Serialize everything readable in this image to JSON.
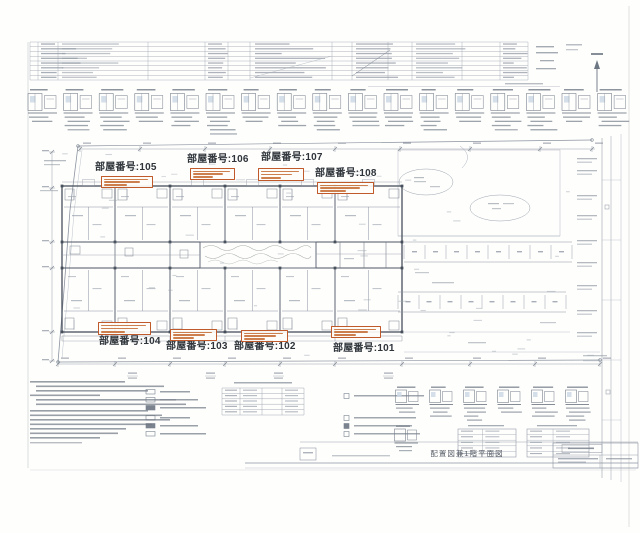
{
  "sheet": {
    "title": "配置図兼1階平面図"
  },
  "rooms": [
    {
      "id": "105",
      "label": "部屋番号:105",
      "label_x": 95,
      "label_y": 163,
      "box_x": 101,
      "box_y": 176,
      "box_w": 52,
      "box_h": 12
    },
    {
      "id": "106",
      "label": "部屋番号:106",
      "label_x": 187,
      "label_y": 155,
      "box_x": 190,
      "box_y": 168,
      "box_w": 45,
      "box_h": 12
    },
    {
      "id": "107",
      "label": "部屋番号:107",
      "label_x": 261,
      "label_y": 153,
      "box_x": 258,
      "box_y": 168,
      "box_w": 46,
      "box_h": 13
    },
    {
      "id": "108",
      "label": "部屋番号:108",
      "label_x": 315,
      "label_y": 169,
      "box_x": 317,
      "box_y": 182,
      "box_w": 57,
      "box_h": 12
    },
    {
      "id": "104",
      "label": "部屋番号:104",
      "label_x": 99,
      "label_y": 337,
      "box_x": 98,
      "box_y": 322,
      "box_w": 53,
      "box_h": 13
    },
    {
      "id": "103",
      "label": "部屋番号:103",
      "label_x": 166,
      "label_y": 342,
      "box_x": 170,
      "box_y": 329,
      "box_w": 47,
      "box_h": 12
    },
    {
      "id": "102",
      "label": "部屋番号:102",
      "label_x": 234,
      "label_y": 342,
      "box_x": 241,
      "box_y": 330,
      "box_w": 47,
      "box_h": 12
    },
    {
      "id": "101",
      "label": "部屋番号:101",
      "label_x": 333,
      "label_y": 344,
      "box_x": 331,
      "box_y": 326,
      "box_w": 50,
      "box_h": 12
    }
  ],
  "colors": {
    "annotation_orange": "#c05a2a",
    "label_ink": "#2e343a",
    "line_light": "#9aa3ae",
    "line_dark": "#46505e",
    "fill_blue": "#ccd9e6"
  }
}
